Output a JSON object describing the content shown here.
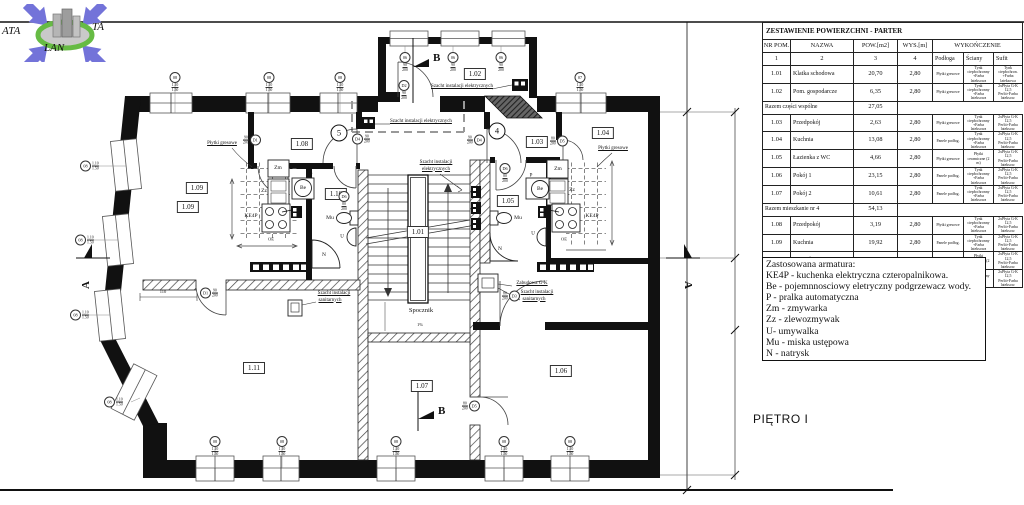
{
  "logo": {
    "left": "ATA",
    "right": "TA",
    "bottom": "LAN"
  },
  "frame": {
    "floor_label": "PIĘTRO I"
  },
  "plan": {
    "rooms": {
      "r101": "1.01",
      "r102": "1.02",
      "r103": "1.03",
      "r104": "1.04",
      "r105": "1.05",
      "r106": "1.06",
      "r107": "1.07",
      "r108": "1.08",
      "r109": "1.09",
      "r110": "1.10",
      "r111": "1.11"
    },
    "texts": {
      "spocznik": "Spocznik",
      "slope": "1%",
      "plytki": "Płytki gresowe",
      "szacht_el": "Szacht instalacji elektrycznych",
      "szacht_el_1": "Szacht instalacji",
      "szacht_el_2": "elektrycznych",
      "szacht_san_1": "Szacht instalacji",
      "szacht_san_2": "sanitarnych",
      "zabudowa": "Zabudowa G-K",
      "dim_door": "110",
      "section_a": "A",
      "section_b": "B"
    },
    "fixtures": {
      "ke4p": "KE4P",
      "zm": "Zm",
      "zz": "Zz",
      "be": "Be",
      "p": "P",
      "u": "U",
      "mu": "Mu",
      "n": "N",
      "oe": "OE"
    },
    "markers": {
      "m4": "4",
      "m5": "5",
      "w06": "06",
      "w07": "07",
      "w08": "08",
      "d1": "D1",
      "d2": "D2",
      "d3": "D3",
      "d4": "D4",
      "d5": "D5",
      "d6": "D6",
      "win_top": "1.10",
      "win_bot": "1.50",
      "d90_top": "90",
      "d90_bot": "200",
      "d80_top": "80",
      "d80_bot": "200"
    }
  },
  "table": {
    "title": "ZESTAWIENIE POWIERZCHNI - PARTER",
    "h": [
      "NR POM.",
      "NAZWA",
      "POW.[m2]",
      "WYS.[m]",
      "WYKOŃCZENIE"
    ],
    "n": [
      "1",
      "2",
      "3",
      "4"
    ],
    "f": [
      "Podłoga",
      "Ściany",
      "Sufit"
    ],
    "rows": [
      {
        "nr": "1.01",
        "nazwa": "Klatka schodowa",
        "pow": "20,70",
        "wys": "2,80",
        "podloga": "Płytki gresowe",
        "sciany": "Tynk ciepłochronny +Farba lateksowa",
        "sufit": "Tynk ciepłochron. +Farba lateksowa"
      },
      {
        "nr": "1.02",
        "nazwa": "Pom. gospodarcze",
        "pow": "6,35",
        "wys": "2,80",
        "podloga": "Płytki gresowe",
        "sciany": "Tynk ciepłochronny +Farba lateksowa",
        "sufit": "2xPłyta G-K 12,5 Perlit+Farba lateksow."
      },
      {
        "label": "Razem części wspólne",
        "value": "27,05"
      },
      {
        "nr": "1.03",
        "nazwa": "Przedpokój",
        "pow": "2,63",
        "wys": "2,80",
        "podloga": "Płytki gresowe",
        "sciany": "Tynk ciepłochronny +Farba lateksowa",
        "sufit": "2xPłyta G-K 12,5 Perlit+Farba lateksow."
      },
      {
        "nr": "1.04",
        "nazwa": "Kuchnia",
        "pow": "13,08",
        "wys": "2,80",
        "podloga": "Panele podłog.",
        "sciany": "Tynk ciepłochronny +Farba lateksowa",
        "sufit": "2xPłyta G-K 12,5 Perlit+Farba lateksow."
      },
      {
        "nr": "1.05",
        "nazwa": "Łazienka z WC",
        "pow": "4,66",
        "wys": "2,80",
        "podloga": "Płytki gresowe",
        "sciany": "Płytki ceramiczne (2 m)",
        "sufit": "2xPłyta G-K 12,5 Perlit+Farba lateksow."
      },
      {
        "nr": "1.06",
        "nazwa": "Pokój 1",
        "pow": "23,15",
        "wys": "2,80",
        "podloga": "Panele podłog.",
        "sciany": "Tynk ciepłochronny +Farba lateksowa",
        "sufit": "2xPłyta G-K 12,5 Perlit+Farba lateksow."
      },
      {
        "nr": "1.07",
        "nazwa": "Pokój 2",
        "pow": "10,61",
        "wys": "2,80",
        "podloga": "Panele podłog.",
        "sciany": "Tynk ciepłochronny +Farba lateksowa",
        "sufit": "2xPłyta G-K 12,5 Perlit+Farba lateksow."
      },
      {
        "label": "Razem mieszkanie nr 4",
        "value": "54,13"
      },
      {
        "nr": "1.08",
        "nazwa": "Przedpokój",
        "pow": "3,19",
        "wys": "2,80",
        "podloga": "Płytki gresowe",
        "sciany": "Tynk ciepłochronny +Farba lateksowa",
        "sufit": "2xPłyta G-K 12,5 Perlit+Farba lateksow."
      },
      {
        "nr": "1.09",
        "nazwa": "Kuchnia",
        "pow": "19,92",
        "wys": "2,80",
        "podloga": "Panele podłog.",
        "sciany": "Tynk ciepłochronny +Farba lateksowa",
        "sufit": "2xPłyta G-K 12,5 Perlit+Farba lateksow."
      },
      {
        "nr": "1.10",
        "nazwa": "Łazienka z WC",
        "pow": "4,91",
        "wys": "2,80",
        "podloga": "Płytki gresowe",
        "sciany": "Płytki ceramiczne (2 m)",
        "sufit": "2xPłyta G-K 12,5 Perlit+Farba lateksow."
      },
      {
        "nr": "1.11",
        "nazwa": "Pokój",
        "pow": "30,56",
        "wys": "2,80",
        "podloga": "Panele podłog.",
        "sciany": "Tynk ciepłochronny +Farba lateksowa",
        "sufit": "2xPłyta G-K 12,5 Perlit+Farba lateksow."
      },
      {
        "label": "Razem mieszkanie nr 5",
        "value": "58,58"
      },
      {
        "label": "RAZEM CAŁE PIĘTRO",
        "value": "139,76"
      }
    ]
  },
  "legend": {
    "title": "Zastosowana armatura:",
    "items": [
      "KE4P - kuchenka elektryczna czteropalnikowa.",
      "Be - pojemnnosciowy eletryczny podgrzewacz wody.",
      "P - pralka automatyczna",
      "Zm - zmywarka",
      "Zz - zlewozmywak",
      "U- umywalka",
      "Mu - miska ustępowa",
      "N - natrysk"
    ]
  }
}
